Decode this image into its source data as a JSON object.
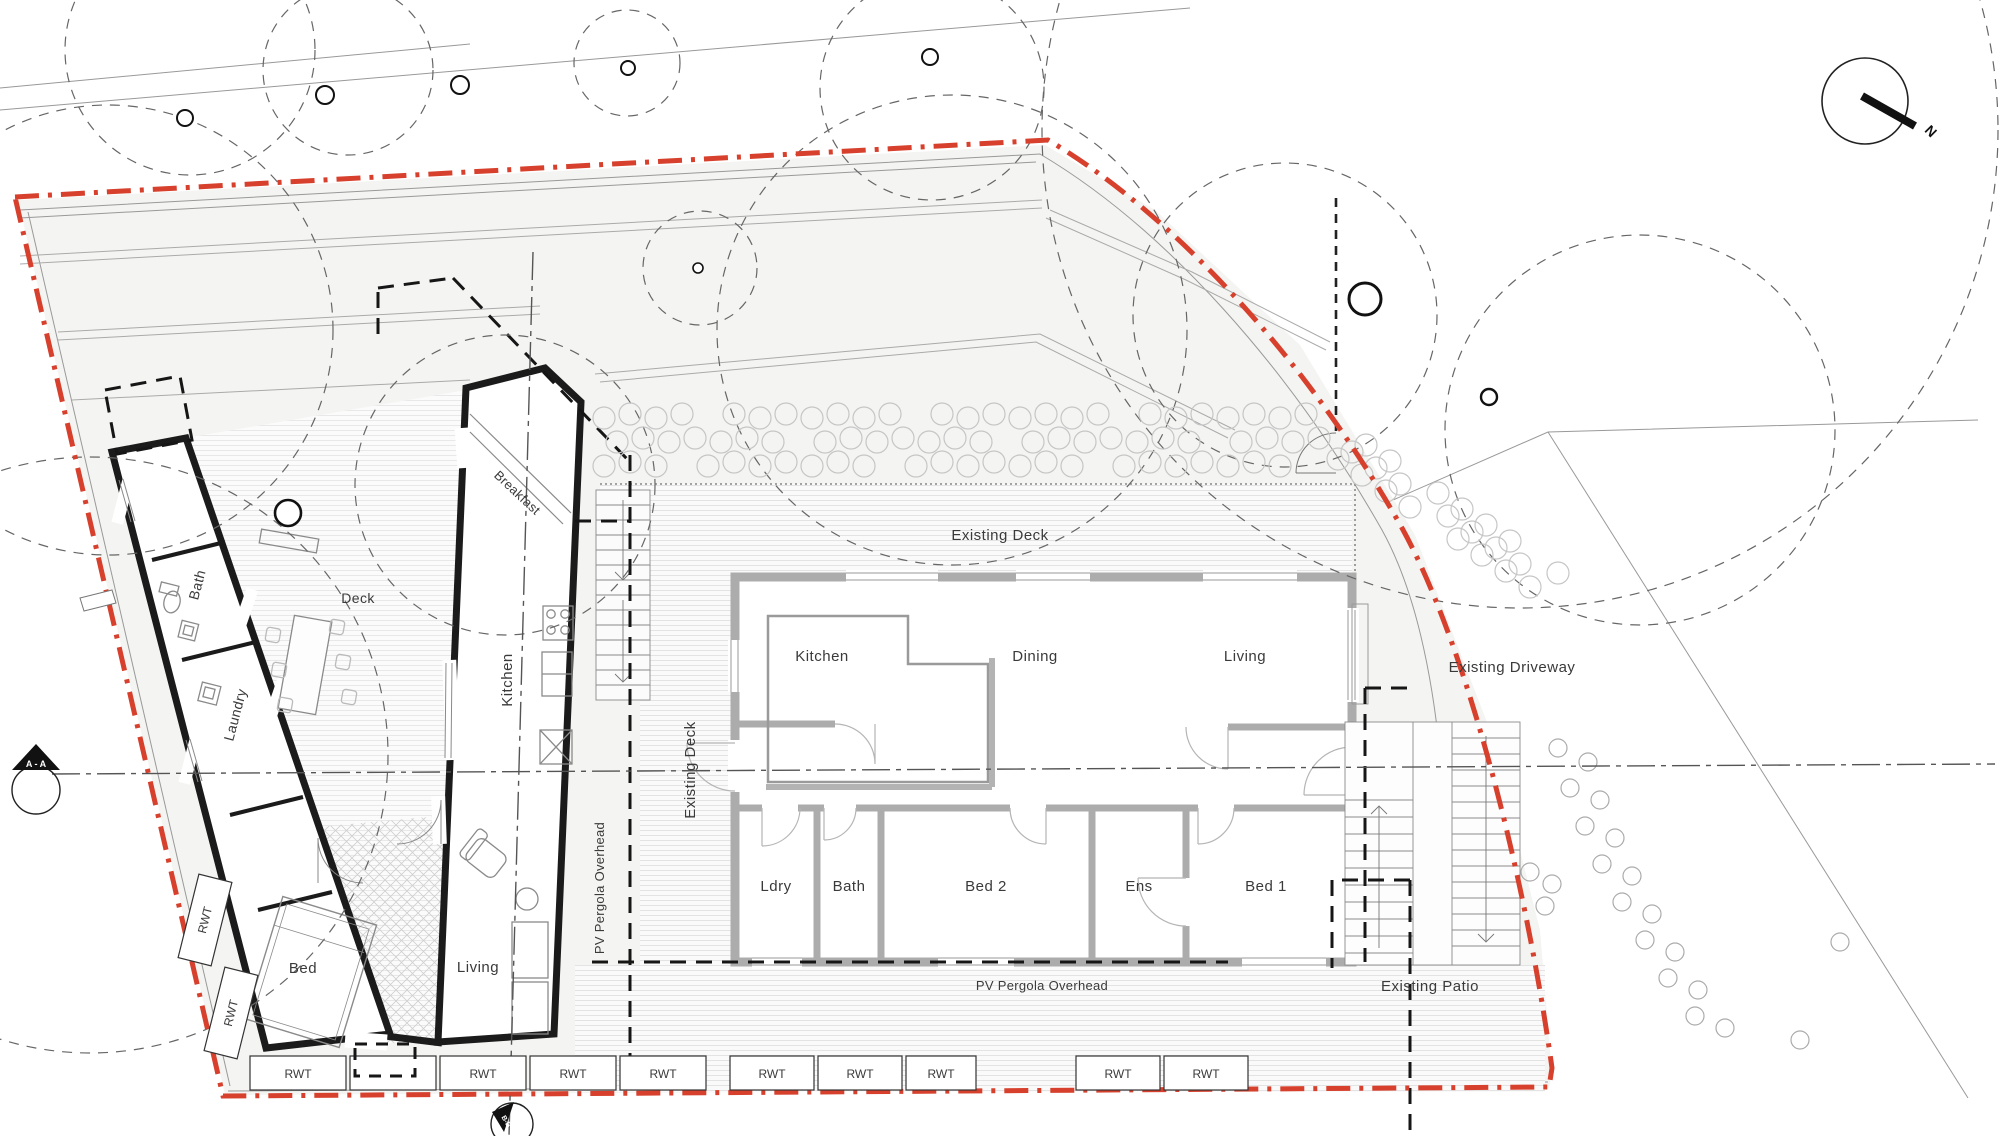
{
  "title": "Residential site and floor plan",
  "colors": {
    "boundary": "#d6402c",
    "site_fill": "#f4f4f2",
    "existing_wall": "#acacac",
    "new_wall": "#1b1b1b",
    "text": "#3a3a3a",
    "hatch_line": "#e3e3e3",
    "tile_line": "#cfcfcf",
    "thin_line": "#979797"
  },
  "site_labels": {
    "existing_deck_top": "Existing Deck",
    "existing_deck_side": "Existing Deck",
    "existing_driveway": "Existing Driveway",
    "existing_patio": "Existing Patio",
    "pv_pergola_horizontal": "PV Pergola Overhead",
    "pv_pergola_vertical": "PV Pergola Overhead"
  },
  "existing_house": {
    "rooms": {
      "kitchen": "Kitchen",
      "dining": "Dining",
      "living": "Living",
      "ldry": "Ldry",
      "bath": "Bath",
      "bed2": "Bed 2",
      "ens": "Ens",
      "bed1": "Bed 1"
    }
  },
  "new_building": {
    "rooms": {
      "breakfast": "Breakfast",
      "kitchen": "Kitchen",
      "living": "Living",
      "deck": "Deck",
      "bath": "Bath",
      "laundry": "Laundry",
      "bed": "Bed"
    }
  },
  "markers": {
    "section_aa": "A - A",
    "section_b": "B-B",
    "north": "N"
  },
  "rwt_label": "RWT",
  "rwt_row": [
    {
      "x": 250,
      "w": 96,
      "label": "RWT"
    },
    {
      "x": 350,
      "w": 86,
      "label": ""
    },
    {
      "x": 440,
      "w": 86,
      "label": "RWT"
    },
    {
      "x": 530,
      "w": 86,
      "label": "RWT"
    },
    {
      "x": 620,
      "w": 86,
      "label": "RWT"
    },
    {
      "x": 730,
      "w": 84,
      "label": "RWT"
    },
    {
      "x": 818,
      "w": 84,
      "label": "RWT"
    },
    {
      "x": 906,
      "w": 70,
      "label": "RWT"
    },
    {
      "x": 1076,
      "w": 84,
      "label": "RWT"
    },
    {
      "x": 1164,
      "w": 84,
      "label": "RWT"
    }
  ],
  "rwt_side": [
    {
      "cx": 205,
      "cy": 920,
      "label": "RWT"
    },
    {
      "cx": 231,
      "cy": 1013,
      "label": "RWT"
    }
  ]
}
